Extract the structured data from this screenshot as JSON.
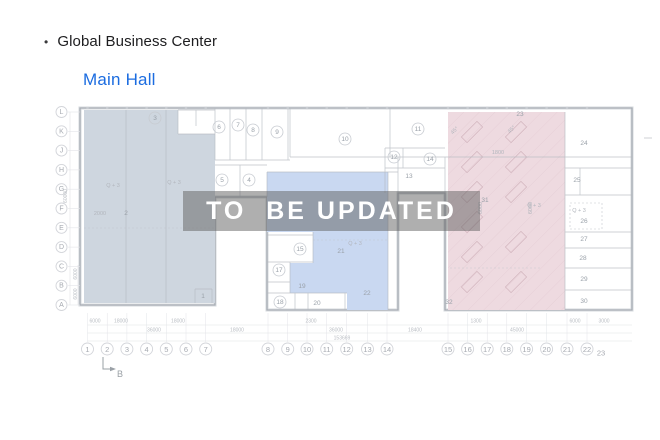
{
  "header": {
    "bullet": "•",
    "title": "Global Business Center",
    "subtitle": "Main Hall"
  },
  "watermark": {
    "text": "TO  BE UPDATED"
  },
  "colors": {
    "subtitle": "#1b6ce0",
    "zone_left": "#ced6df",
    "zone_center": "#c9d8f1",
    "zone_right": "#eedae0",
    "watermark_band": "rgba(95,95,95,0.5)",
    "watermark_text": "#ffffff"
  },
  "plan": {
    "row_axis": [
      {
        "label": "L",
        "y": 112
      },
      {
        "label": "K",
        "y": 131.3
      },
      {
        "label": "J",
        "y": 150.6
      },
      {
        "label": "H",
        "y": 169.9
      },
      {
        "label": "G",
        "y": 189.2
      },
      {
        "label": "F",
        "y": 208.5
      },
      {
        "label": "E",
        "y": 227.8
      },
      {
        "label": "D",
        "y": 247.1
      },
      {
        "label": "C",
        "y": 266.4
      },
      {
        "label": "B",
        "y": 285.7
      },
      {
        "label": "A",
        "y": 305
      }
    ],
    "col_axis": [
      {
        "label": "1",
        "x": 87.5
      },
      {
        "label": "2",
        "x": 107.2
      },
      {
        "label": "3",
        "x": 126.9
      },
      {
        "label": "4",
        "x": 146.6
      },
      {
        "label": "5",
        "x": 166.3
      },
      {
        "label": "6",
        "x": 186
      },
      {
        "label": "7",
        "x": 205.7
      },
      {
        "label": "8",
        "x": 268
      },
      {
        "label": "9",
        "x": 287.7
      },
      {
        "label": "10",
        "x": 307
      },
      {
        "label": "11",
        "x": 326.7
      },
      {
        "label": "12",
        "x": 346.7
      },
      {
        "label": "13",
        "x": 367.5
      },
      {
        "label": "14",
        "x": 387
      },
      {
        "label": "15",
        "x": 448
      },
      {
        "label": "16",
        "x": 467.6
      },
      {
        "label": "17",
        "x": 487.2
      },
      {
        "label": "18",
        "x": 506.8
      },
      {
        "label": "19",
        "x": 526.6
      },
      {
        "label": "20",
        "x": 546.6
      },
      {
        "label": "21",
        "x": 567
      },
      {
        "label": "22",
        "x": 587
      }
    ],
    "col_end": {
      "label": "23",
      "x": 601,
      "y": 353
    },
    "rooms": [
      {
        "n": "3",
        "x": 155,
        "y": 118,
        "c": true
      },
      {
        "n": "6",
        "x": 219,
        "y": 127,
        "c": true
      },
      {
        "n": "7",
        "x": 238,
        "y": 125,
        "c": true
      },
      {
        "n": "8",
        "x": 253,
        "y": 130,
        "c": true
      },
      {
        "n": "9",
        "x": 277,
        "y": 132,
        "c": true
      },
      {
        "n": "10",
        "x": 345,
        "y": 139,
        "c": true
      },
      {
        "n": "11",
        "x": 418,
        "y": 129,
        "c": true
      },
      {
        "n": "12",
        "x": 394,
        "y": 157,
        "c": true
      },
      {
        "n": "14",
        "x": 430,
        "y": 159,
        "c": true
      },
      {
        "n": "5",
        "x": 222,
        "y": 180,
        "c": true
      },
      {
        "n": "4",
        "x": 249,
        "y": 180,
        "c": true
      },
      {
        "n": "15",
        "x": 300,
        "y": 249,
        "c": true
      },
      {
        "n": "17",
        "x": 279,
        "y": 270,
        "c": true
      },
      {
        "n": "18",
        "x": 280,
        "y": 302,
        "c": true
      },
      {
        "n": "13",
        "x": 409,
        "y": 176,
        "c": false
      },
      {
        "n": "19",
        "x": 302,
        "y": 286,
        "c": false
      },
      {
        "n": "20",
        "x": 317,
        "y": 303,
        "c": false
      },
      {
        "n": "21",
        "x": 341,
        "y": 251,
        "c": false
      },
      {
        "n": "22",
        "x": 367,
        "y": 293,
        "c": false
      },
      {
        "n": "2",
        "x": 126,
        "y": 213,
        "c": false
      },
      {
        "n": "1",
        "x": 203,
        "y": 296,
        "c": false
      },
      {
        "n": "23",
        "x": 520,
        "y": 114,
        "c": false
      },
      {
        "n": "24",
        "x": 584,
        "y": 143,
        "c": false
      },
      {
        "n": "25",
        "x": 577,
        "y": 180,
        "c": false
      },
      {
        "n": "26",
        "x": 584,
        "y": 221,
        "c": false
      },
      {
        "n": "27",
        "x": 584,
        "y": 239,
        "c": false
      },
      {
        "n": "28",
        "x": 583,
        "y": 258,
        "c": false
      },
      {
        "n": "29",
        "x": 584,
        "y": 279,
        "c": false
      },
      {
        "n": "30",
        "x": 584,
        "y": 301,
        "c": false
      },
      {
        "n": "31",
        "x": 485,
        "y": 200,
        "c": false
      },
      {
        "n": "32",
        "x": 449,
        "y": 302,
        "c": false
      }
    ],
    "notes": [
      {
        "t": "Q + 3",
        "x": 113,
        "y": 186
      },
      {
        "t": "Q + 3",
        "x": 174,
        "y": 183
      },
      {
        "t": "Q + 3",
        "x": 355,
        "y": 244
      },
      {
        "t": "Q + 3",
        "x": 534,
        "y": 206
      },
      {
        "t": "Q + 3",
        "x": 579,
        "y": 211
      },
      {
        "t": "2000",
        "x": 100,
        "y": 214
      },
      {
        "t": "1800",
        "x": 498,
        "y": 153
      },
      {
        "t": "45°",
        "x": 455,
        "y": 131,
        "rot": -45
      },
      {
        "t": "45°",
        "x": 512,
        "y": 130,
        "rot": -45
      },
      {
        "t": "6000",
        "x": 481,
        "y": 208,
        "rot": -90
      },
      {
        "t": "6000",
        "x": 531,
        "y": 208,
        "rot": -90
      }
    ],
    "dims": [
      {
        "t": "6000",
        "x": 95,
        "y": 321.5
      },
      {
        "t": "18000",
        "x": 121,
        "y": 321.5
      },
      {
        "t": "18000",
        "x": 178,
        "y": 321.5
      },
      {
        "t": "2300",
        "x": 311,
        "y": 321.5
      },
      {
        "t": "1300",
        "x": 476,
        "y": 321.5
      },
      {
        "t": "6000",
        "x": 575,
        "y": 321.5
      },
      {
        "t": "3000",
        "x": 604,
        "y": 321.5
      },
      {
        "t": "36000",
        "x": 154,
        "y": 330.5
      },
      {
        "t": "18000",
        "x": 237,
        "y": 330.5
      },
      {
        "t": "36000",
        "x": 336,
        "y": 330.5
      },
      {
        "t": "18400",
        "x": 415,
        "y": 330.5
      },
      {
        "t": "45000",
        "x": 517,
        "y": 330.5
      },
      {
        "t": "153669",
        "x": 342,
        "y": 338.5
      },
      {
        "t": "60000",
        "x": 66,
        "y": 196,
        "rot": -90
      },
      {
        "t": "6000",
        "x": 76,
        "y": 274,
        "rot": -90
      },
      {
        "t": "6000",
        "x": 76,
        "y": 294,
        "rot": -90
      }
    ],
    "section_marker": {
      "label": "B"
    }
  }
}
